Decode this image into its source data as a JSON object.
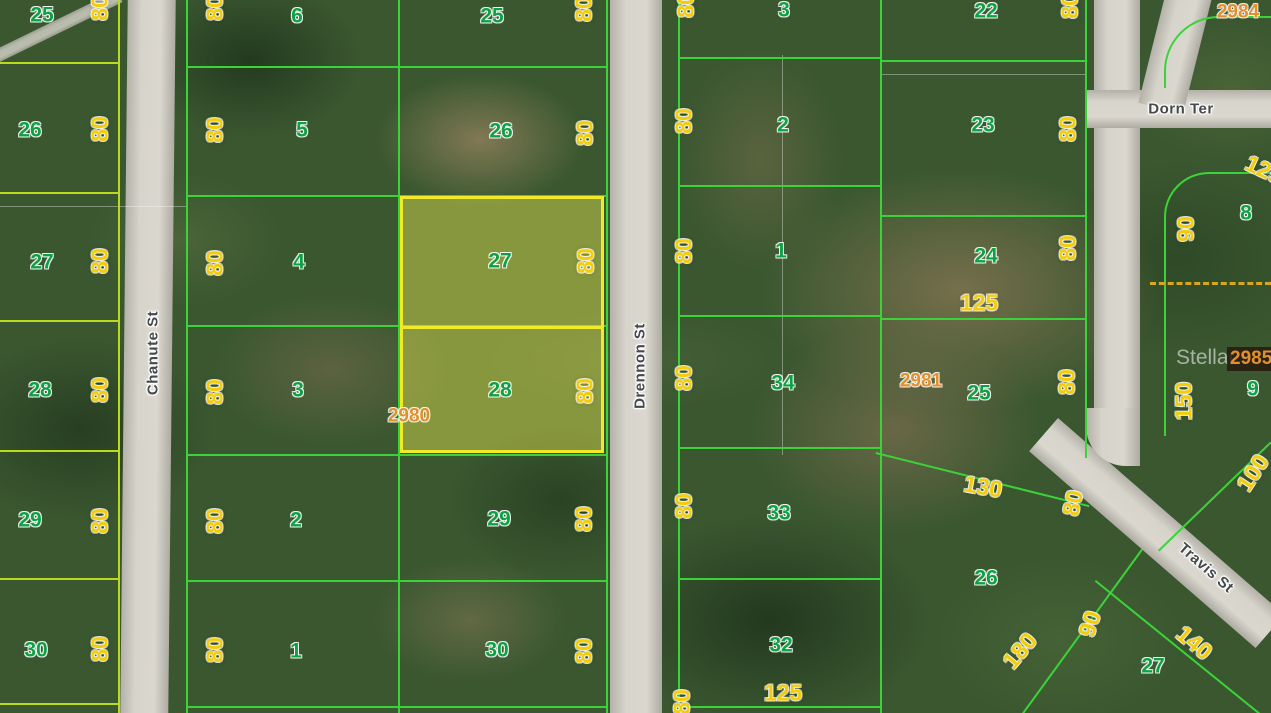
{
  "map": {
    "description": "Aerial parcel map with highlighted lots",
    "highlight": {
      "lots": [
        "27",
        "28"
      ],
      "parcel_id": "2980"
    },
    "colors": {
      "highlight_yellow": "#f2ea28",
      "parcel_line_green": "#3cd33a",
      "parcel_line_chartreuse": "#b9da1e",
      "lot_number_green": "#0da144",
      "dimension_yellow": "#f4cd08",
      "parcel_id_orange": "#e2902d"
    },
    "watermark": {
      "t": "Stellar",
      "x": 1176,
      "y": 347
    },
    "boxed_parcel_id": {
      "t": "2985"
    },
    "streets": [
      {
        "t": "Chanute St",
        "x": 153,
        "y": 353,
        "r": -90
      },
      {
        "t": "Drennon St",
        "x": 640,
        "y": 366,
        "r": -90
      },
      {
        "t": "Dorn Ter",
        "x": 1181,
        "y": 109,
        "r": 0
      },
      {
        "t": "Travis St",
        "x": 1206,
        "y": 568,
        "r": 41
      }
    ],
    "lot_numbers": [
      {
        "t": "25",
        "x": 42,
        "y": 15
      },
      {
        "t": "26",
        "x": 30,
        "y": 130
      },
      {
        "t": "27",
        "x": 42,
        "y": 262
      },
      {
        "t": "28",
        "x": 40,
        "y": 390
      },
      {
        "t": "29",
        "x": 30,
        "y": 520
      },
      {
        "t": "30",
        "x": 36,
        "y": 650
      },
      {
        "t": "6",
        "x": 297,
        "y": 16
      },
      {
        "t": "5",
        "x": 302,
        "y": 130
      },
      {
        "t": "4",
        "x": 299,
        "y": 262
      },
      {
        "t": "3",
        "x": 298,
        "y": 390
      },
      {
        "t": "2",
        "x": 296,
        "y": 520
      },
      {
        "t": "1",
        "x": 296,
        "y": 651
      },
      {
        "t": "25",
        "x": 492,
        "y": 16
      },
      {
        "t": "26",
        "x": 501,
        "y": 131
      },
      {
        "t": "27",
        "x": 500,
        "y": 261
      },
      {
        "t": "28",
        "x": 500,
        "y": 390
      },
      {
        "t": "29",
        "x": 499,
        "y": 519
      },
      {
        "t": "30",
        "x": 497,
        "y": 650
      },
      {
        "t": "3",
        "x": 784,
        "y": 10
      },
      {
        "t": "2",
        "x": 783,
        "y": 125
      },
      {
        "t": "1",
        "x": 781,
        "y": 251
      },
      {
        "t": "34",
        "x": 783,
        "y": 383
      },
      {
        "t": "33",
        "x": 779,
        "y": 513
      },
      {
        "t": "32",
        "x": 781,
        "y": 645
      },
      {
        "t": "22",
        "x": 986,
        "y": 11
      },
      {
        "t": "23",
        "x": 983,
        "y": 125
      },
      {
        "t": "24",
        "x": 986,
        "y": 256
      },
      {
        "t": "25",
        "x": 979,
        "y": 393
      },
      {
        "t": "26",
        "x": 986,
        "y": 578
      },
      {
        "t": "8",
        "x": 1246,
        "y": 213
      },
      {
        "t": "9",
        "x": 1253,
        "y": 389
      },
      {
        "t": "27",
        "x": 1153,
        "y": 666
      }
    ],
    "dimensions": [
      {
        "t": "80",
        "x": 100,
        "y": 8,
        "r": -90
      },
      {
        "t": "80",
        "x": 100,
        "y": 129,
        "r": -90
      },
      {
        "t": "80",
        "x": 100,
        "y": 261,
        "r": -90
      },
      {
        "t": "80",
        "x": 100,
        "y": 390,
        "r": -90
      },
      {
        "t": "80",
        "x": 100,
        "y": 521,
        "r": -90
      },
      {
        "t": "80",
        "x": 100,
        "y": 649,
        "r": -90
      },
      {
        "t": "80",
        "x": 215,
        "y": 8,
        "r": -90
      },
      {
        "t": "80",
        "x": 215,
        "y": 130,
        "r": -90
      },
      {
        "t": "80",
        "x": 215,
        "y": 263,
        "r": -90
      },
      {
        "t": "80",
        "x": 215,
        "y": 392,
        "r": -90
      },
      {
        "t": "80",
        "x": 215,
        "y": 521,
        "r": -90
      },
      {
        "t": "80",
        "x": 215,
        "y": 650,
        "r": -90
      },
      {
        "t": "80",
        "x": 584,
        "y": 9,
        "r": -90
      },
      {
        "t": "80",
        "x": 585,
        "y": 133,
        "r": -90
      },
      {
        "t": "80",
        "x": 586,
        "y": 261,
        "r": -90
      },
      {
        "t": "80",
        "x": 585,
        "y": 391,
        "r": -90
      },
      {
        "t": "80",
        "x": 584,
        "y": 519,
        "r": -90
      },
      {
        "t": "80",
        "x": 584,
        "y": 651,
        "r": -90
      },
      {
        "t": "80",
        "x": 686,
        "y": 5,
        "r": -90
      },
      {
        "t": "80",
        "x": 684,
        "y": 121,
        "r": -90
      },
      {
        "t": "80",
        "x": 684,
        "y": 251,
        "r": -90
      },
      {
        "t": "80",
        "x": 684,
        "y": 378,
        "r": -90
      },
      {
        "t": "80",
        "x": 684,
        "y": 506,
        "r": -90
      },
      {
        "t": "80",
        "x": 682,
        "y": 702,
        "r": -90
      },
      {
        "t": "80",
        "x": 1070,
        "y": 6,
        "r": -90
      },
      {
        "t": "80",
        "x": 1068,
        "y": 129,
        "r": -90
      },
      {
        "t": "80",
        "x": 1068,
        "y": 248,
        "r": -90
      },
      {
        "t": "80",
        "x": 1067,
        "y": 382,
        "r": -90
      },
      {
        "t": "80",
        "x": 1073,
        "y": 503,
        "r": -78
      },
      {
        "t": "90",
        "x": 1186,
        "y": 229,
        "r": -90
      },
      {
        "t": "150",
        "x": 1184,
        "y": 401,
        "r": -90
      },
      {
        "t": "125",
        "x": 979,
        "y": 303,
        "r": 0
      },
      {
        "t": "125",
        "x": 783,
        "y": 693,
        "r": 0
      },
      {
        "t": "130",
        "x": 983,
        "y": 487,
        "r": 10
      },
      {
        "t": "125",
        "x": 1264,
        "y": 170,
        "r": 25
      },
      {
        "t": "140",
        "x": 1194,
        "y": 643,
        "r": 40
      },
      {
        "t": "100",
        "x": 1253,
        "y": 473,
        "r": -57
      },
      {
        "t": "90",
        "x": 1090,
        "y": 624,
        "r": -72
      },
      {
        "t": "180",
        "x": 1020,
        "y": 651,
        "r": -50
      }
    ],
    "parcel_ids": [
      {
        "t": "2980",
        "x": 409,
        "y": 416
      },
      {
        "t": "2981",
        "x": 921,
        "y": 381
      },
      {
        "t": "2984",
        "x": 1238,
        "y": 12
      }
    ]
  }
}
